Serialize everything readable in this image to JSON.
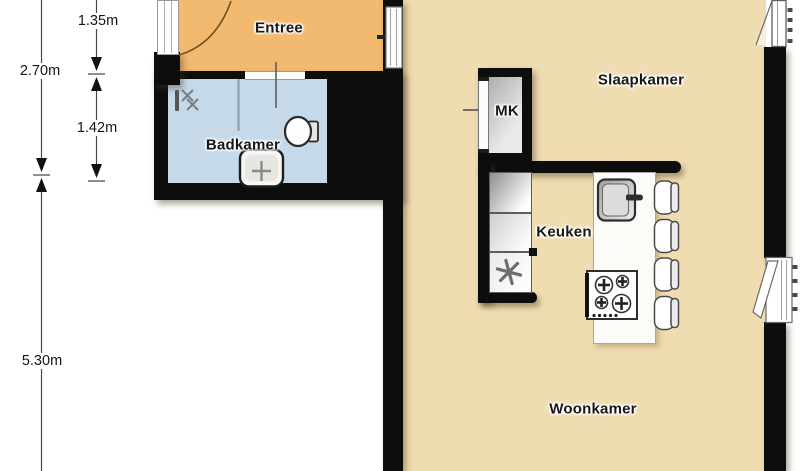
{
  "plan": {
    "type": "floorplan",
    "rooms": {
      "entree": {
        "label": "Entree"
      },
      "badkamer": {
        "label": "Badkamer"
      },
      "slaapkamer": {
        "label": "Slaapkamer"
      },
      "keuken": {
        "label": "Keuken"
      },
      "woonkamer": {
        "label": "Woonkamer"
      },
      "mk": {
        "label": "MK"
      }
    },
    "dimensions": {
      "entree_depth": "1.35m",
      "left_total_top": "2.70m",
      "badkamer_depth": "1.42m",
      "left_total_bottom": "5.30m"
    },
    "colors": {
      "floor_main": "#f0dcb1",
      "floor_entree": "#f1ba70",
      "floor_badkamer": "#c5d9e9",
      "wall": "#0d0d0d",
      "outside": "#ffffff"
    },
    "fixture_icons": [
      "front-door-arc-icon",
      "entry-sidelight-icon",
      "bathroom-door-icon",
      "shower-partition-icon",
      "shower-mixer-icon",
      "toilet-icon",
      "washbasin-icon",
      "meter-cupboard-door-icon",
      "kitchen-counter-icon",
      "asterisk-appliance-icon",
      "island-sink-icon",
      "cooktop-icon",
      "bar-stool-icon",
      "bedroom-door-icon",
      "balcony-door-top-icon",
      "balcony-door-right-icon",
      "dimension-arrows-icon"
    ]
  }
}
